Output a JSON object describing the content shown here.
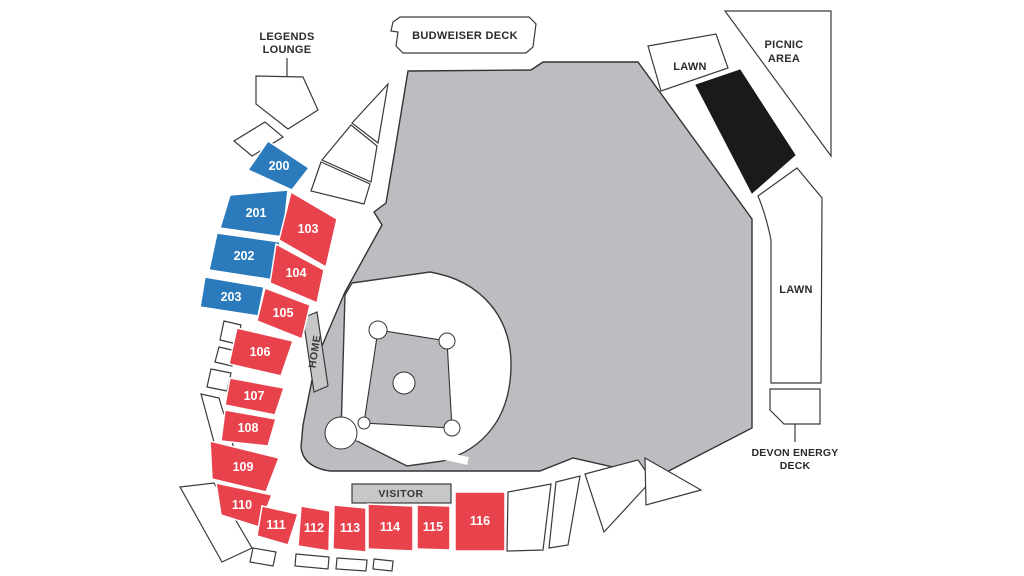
{
  "map": {
    "legends_lounge": {
      "line1": "LEGENDS",
      "line2": "LOUNGE"
    },
    "budweiser_deck": {
      "label": "BUDWEISER DECK"
    },
    "picnic_area": {
      "line1": "PICNIC",
      "line2": "AREA"
    },
    "lawn_top": {
      "label": "LAWN"
    },
    "lawn_right": {
      "label": "LAWN"
    },
    "devon_energy_deck": {
      "line1": "DEVON ENERGY",
      "line2": "DECK"
    },
    "home_dugout": {
      "label": "HOME"
    },
    "visitor_dugout": {
      "label": "VISITOR"
    }
  },
  "sections": {
    "premium": [
      {
        "label": "200"
      },
      {
        "label": "201"
      },
      {
        "label": "202"
      },
      {
        "label": "203"
      }
    ],
    "reserved": [
      {
        "label": "103"
      },
      {
        "label": "104"
      },
      {
        "label": "105"
      },
      {
        "label": "106"
      },
      {
        "label": "107"
      },
      {
        "label": "108"
      },
      {
        "label": "109"
      },
      {
        "label": "110"
      },
      {
        "label": "111"
      },
      {
        "label": "112"
      },
      {
        "label": "113"
      },
      {
        "label": "114"
      },
      {
        "label": "115"
      },
      {
        "label": "116"
      }
    ]
  },
  "colors": {
    "reserved_red": "#E8424C",
    "premium_blue": "#2A7ABC",
    "field_gray": "#BBBDC0",
    "dugout_gray": "#C5C7C9",
    "blackout_section": "#1A1A1A",
    "outline": "#333333",
    "label_text": "#2B2B2B",
    "section_text": "#FFFFFF"
  }
}
